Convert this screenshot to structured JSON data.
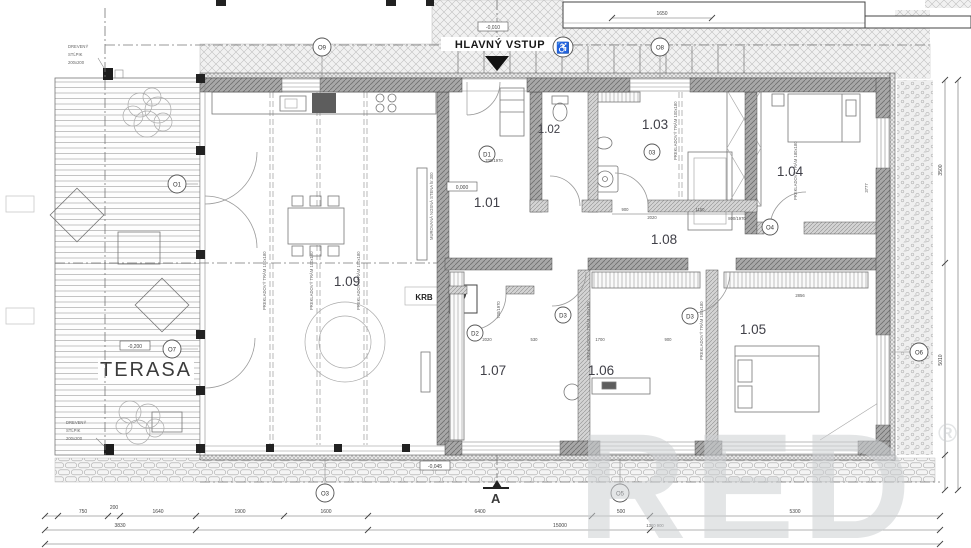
{
  "plan": {
    "entrance_label": "HLAVNÝ VSTUP",
    "terrace_label": "TERASA",
    "fireplace_label": "KRB",
    "section_label": "A",
    "watermark_text": "RED",
    "watermark_reg": "®",
    "accessibility_icon": "♿"
  },
  "rooms": [
    {
      "id": "1.01"
    },
    {
      "id": "1.02"
    },
    {
      "id": "1.03"
    },
    {
      "id": "1.04"
    },
    {
      "id": "1.05"
    },
    {
      "id": "1.06"
    },
    {
      "id": "1.07"
    },
    {
      "id": "1.08"
    },
    {
      "id": "1.09"
    }
  ],
  "markers": {
    "o1": "O1",
    "o3": "O3",
    "o4": "O4",
    "o5": "O5",
    "o6": "O6",
    "o7": "O7",
    "o8": "O8",
    "o9": "O9",
    "d1": "D1",
    "d2": "D2",
    "d3a": "D3",
    "d3b": "D3",
    "d03": "03"
  },
  "elevations": {
    "zero": "0,000",
    "minus010": "-0,010",
    "minus200": "-0,200",
    "minus045": "-0,045"
  },
  "notes": {
    "wood_post_line1": "DREVENÝ",
    "wood_post_line2": "STĹPIK",
    "wood_post_line3": "200x200",
    "bearing_wall": "MUROVANÁ NOSNÁ STENA hr.300",
    "beam_180": "PREKLADOVÝ TRÁM 180x180",
    "beam_100": "PREKLADOVÝ TRÁM 100x180"
  },
  "dimensions": {
    "bottom_row1": [
      "750",
      "200",
      "1640",
      "1900",
      "1600",
      "6400",
      "500",
      "5300"
    ],
    "bottom_row2": [
      "3830",
      "15000",
      "1300 900"
    ],
    "right": [
      "3500",
      "5010"
    ],
    "top": "1650",
    "door_1": "700/1970",
    "door_2": "800/1970",
    "door_3": "700/1970",
    "interior": [
      "900",
      "2020",
      "1150",
      "2856",
      "3777",
      "2020",
      "530",
      "1700",
      "900"
    ]
  },
  "colors": {
    "label": "#3a3a3a",
    "wall": "#a3a3a3",
    "watermark": "#cdd0d3",
    "dashline": "#777777",
    "paving": "#c2c2c2"
  }
}
